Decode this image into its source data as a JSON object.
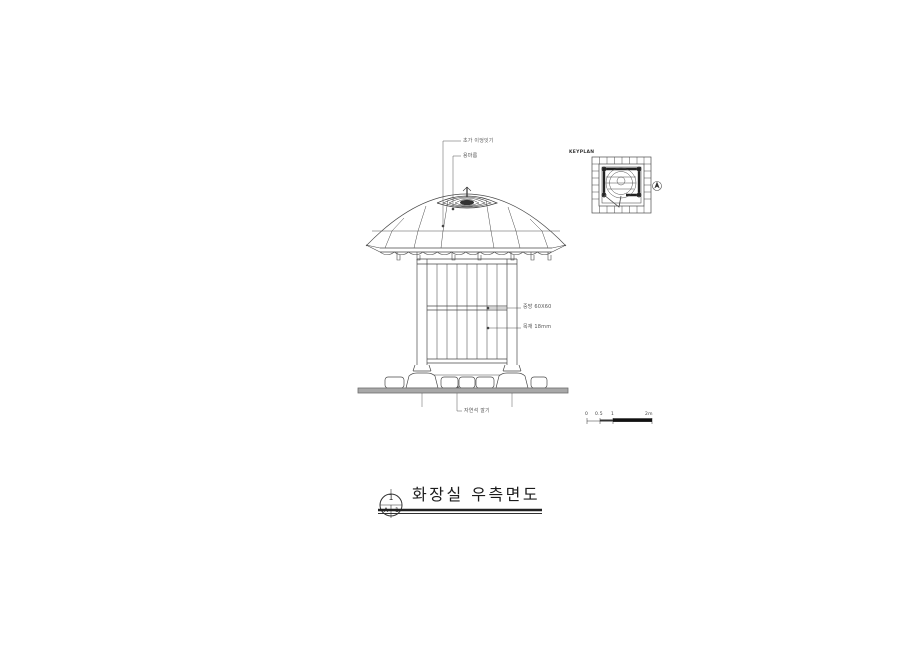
{
  "drawing": {
    "title": "화장실 우측면도",
    "sheet_ref": {
      "top": "1",
      "bottom_left": "A",
      "bottom_right": "1"
    },
    "annotations": {
      "roof_thatch": "초가 이엉잇기",
      "ridge": "용마름",
      "mid_rail": "중방 60X60",
      "wall_plank": "목재 18mm",
      "base_stone": "자연석 깔기"
    },
    "keyplan": {
      "label": "KEYPLAN"
    },
    "scale_bar": {
      "ticks": [
        "0",
        "0.5",
        "1",
        "2m"
      ]
    },
    "colors": {
      "line": "#4a4a4a",
      "ground_fill": "#a8a8a8",
      "dark": "#2a2a2a"
    }
  }
}
